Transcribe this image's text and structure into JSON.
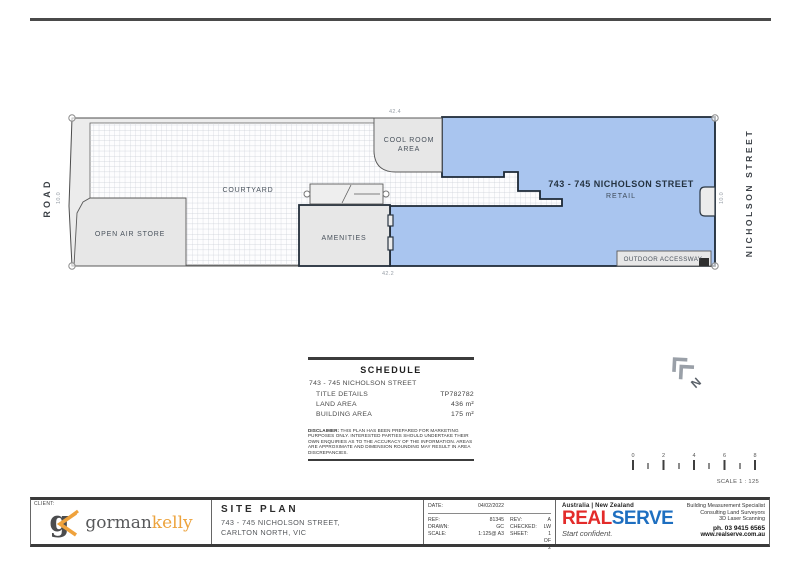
{
  "plan": {
    "road": "ROAD",
    "street": "NICHOLSON STREET",
    "dim_top": "42.4",
    "dim_bottom": "42.2",
    "dim_left": "10.0",
    "dim_right": "10.0",
    "courtyard": "COURTYARD",
    "cool_room_line1": "COOL ROOM",
    "cool_room_line2": "AREA",
    "open_air_store": "OPEN AIR STORE",
    "amenities": "AMENITIES",
    "outdoor_accessway": "OUTDOOR ACCESSWAY",
    "retail_title": "743 - 745 NICHOLSON STREET",
    "retail_subtitle": "RETAIL",
    "north_label": "N"
  },
  "scale_bar": {
    "t0": "0",
    "t2": "2",
    "t4": "4",
    "t6": "6",
    "t8": "8",
    "label": "SCALE 1 : 125"
  },
  "schedule": {
    "title": "SCHEDULE",
    "property": "743 - 745 NICHOLSON STREET",
    "rows": [
      {
        "label": "TITLE DETAILS",
        "value": "TP782782"
      },
      {
        "label": "LAND AREA",
        "value": "436 m²"
      },
      {
        "label": "BUILDING AREA",
        "value": "175 m²"
      }
    ],
    "disclaimer_lead": "DISCLAIMER:",
    "disclaimer": " THIS PLAN HAS BEEN PREPARED FOR MARKETING PURPOSES ONLY. INTERESTED PARTIES SHOULD UNDERTAKE THEIR OWN ENQUIRIES AS TO THE ACCURACY OF THE INFORMATION. AREAS ARE APPROXIMATE AND DIMENSION ROUNDING MAY RESULT IN AREA DISCREPANCIES."
  },
  "title_block": {
    "client_label": "CLIENT:",
    "logo_g": "g",
    "logo_name_1": "gorman",
    "logo_name_2": "kelly",
    "drawing_title": "SITE PLAN",
    "address_line1": "743 - 745 NICHOLSON STREET,",
    "address_line2": "CARLTON NORTH, VIC",
    "date_label": "DATE:",
    "date_value": "04/02/2022",
    "ref_label": "REF:",
    "ref_value": "81345",
    "rev_label": "REV:",
    "rev_value": "A",
    "drawn_label": "DRAWN:",
    "drawn_value": "GC",
    "checked_label": "CHECKED:",
    "checked_value": "LW",
    "scale_label": "SCALE:",
    "scale_value": "1:125@ A3",
    "sheet_label": "SHEET:",
    "sheet_value": "1 OF 2",
    "region": "Australia | New Zealand",
    "brand_part1": "REAL",
    "brand_part2": "SERVE",
    "tagline": "Start confident.",
    "service_1": "Building Measurement Specialist",
    "service_2": "Consulting Land Surveyors",
    "service_3": "3D Laser Scanning",
    "phone": "ph. 03 9415 6565",
    "website": "www.realserve.com.au"
  },
  "colors": {
    "retail_fill": "#a9c5ef",
    "brand_red": "#e32b2a",
    "brand_blue": "#1e6fc0",
    "logo_orange": "#efa23c"
  }
}
